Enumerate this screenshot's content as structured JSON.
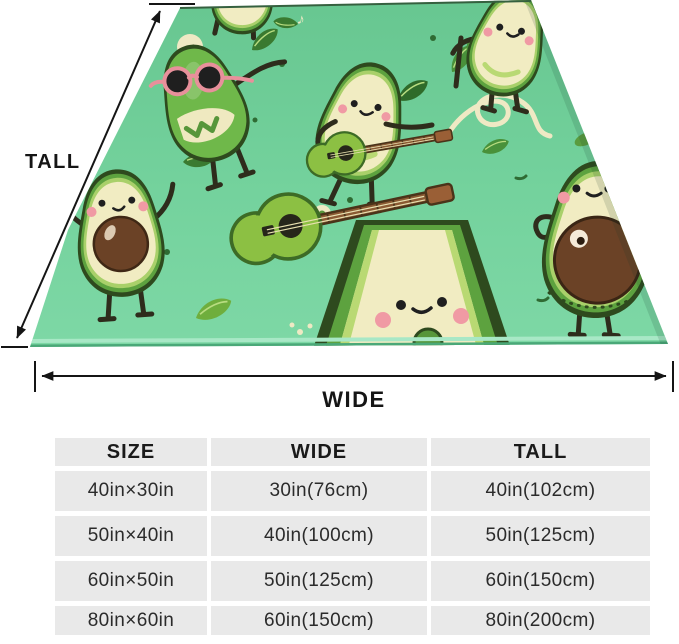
{
  "diagram": {
    "tall_label": "TALL",
    "wide_label": "WIDE"
  },
  "size_chart": {
    "headers": [
      "SIZE",
      "WIDE",
      "TALL"
    ],
    "rows": [
      [
        "40in×30in",
        "30in(76cm)",
        "40in(102cm)"
      ],
      [
        "50in×40in",
        "40in(100cm)",
        "50in(125cm)"
      ],
      [
        "60in×50in",
        "50in(125cm)",
        "60in(150cm)"
      ],
      [
        "80in×60in",
        "60in(150cm)",
        "80in(200cm)"
      ]
    ]
  },
  "icons": {
    "music_note_double": "♫",
    "music_note_single": "♪"
  },
  "colors": {
    "page_background": "#FFFFFF",
    "blanket_green": "#6FCD97",
    "avocado_cream": "#F1ECC2",
    "avocado_skin_green": "#5DA23F",
    "pit_brown": "#6B4226",
    "cheek_pink": "#F09AA4",
    "sunglasses_pink": "#E8909B",
    "guitar_green": "#8CC043",
    "guitar_neck_brown": "#8A5A33",
    "dimension_black": "#151515",
    "table_cell_gray": "#E9E9E9"
  }
}
